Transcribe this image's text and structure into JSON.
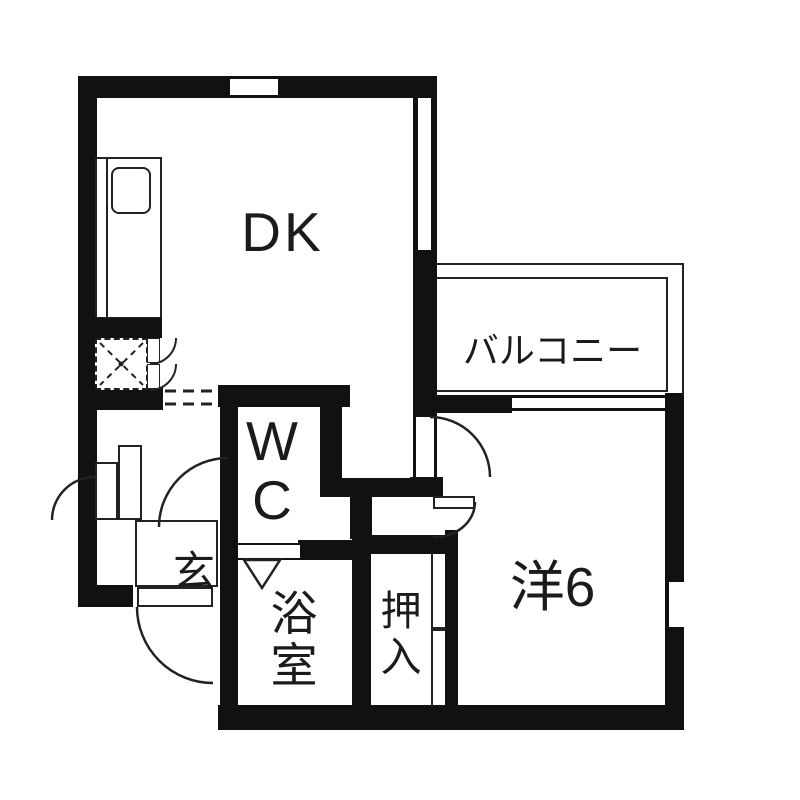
{
  "floorplan": {
    "kind": "apartment-floor-plan",
    "language": "ja",
    "rooms": [
      {
        "name": "dining-kitchen",
        "label": "DK"
      },
      {
        "name": "balcony",
        "label": "バルコニー"
      },
      {
        "name": "western-room-6",
        "label": "洋6"
      },
      {
        "name": "toilet",
        "label": "WC",
        "lines": [
          "W",
          "C"
        ]
      },
      {
        "name": "entrance",
        "label": "玄"
      },
      {
        "name": "bathroom",
        "label": "浴室",
        "chars": [
          "浴",
          "室"
        ]
      },
      {
        "name": "closet",
        "label": "押入",
        "chars": [
          "押",
          "入"
        ]
      }
    ],
    "fixtures": [
      {
        "name": "kitchen-sink"
      },
      {
        "name": "kitchen-counter"
      },
      {
        "name": "stove-space-hatched"
      },
      {
        "name": "bath-door-triangle"
      },
      {
        "name": "closet-sliding-door"
      }
    ],
    "colors": {
      "wall": "#111111",
      "line": "#222222",
      "background": "#ffffff",
      "text": "#1b1b1b"
    }
  }
}
